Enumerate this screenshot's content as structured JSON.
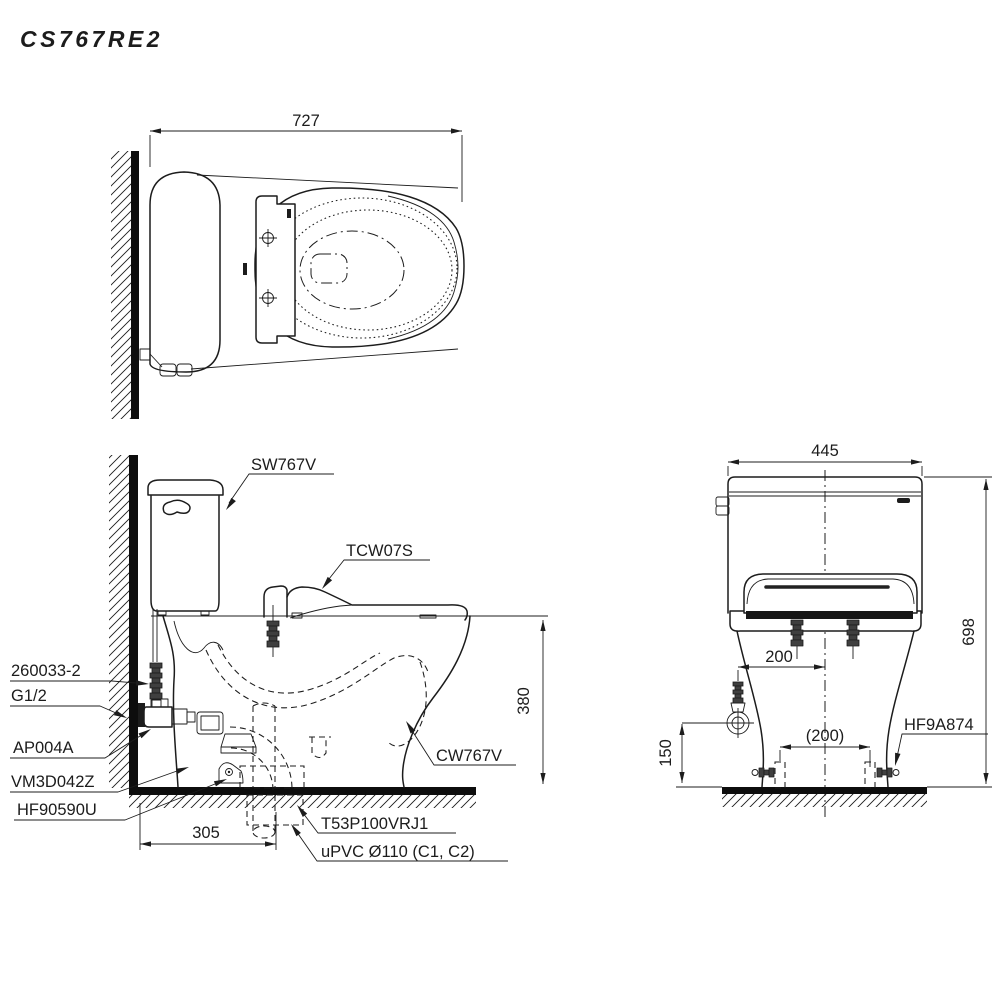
{
  "title": "CS767RE2",
  "top": {
    "dim_width": "727"
  },
  "side": {
    "dim_rim_height": "380",
    "dim_drain_offset": "305",
    "label_tank": "SW767V",
    "label_seat_unit": "TCW07S",
    "label_supply_hose": "260033-2",
    "label_thread": "G1/2",
    "label_stop_valve": "AP004A",
    "label_connector": "VM3D042Z",
    "label_floor_fixing": "HF90590U",
    "label_bowl": "CW767V",
    "label_flange": "T53P100VRJ1",
    "label_drain_pipe": "uPVC Ø110 (C1, C2)"
  },
  "front": {
    "dim_width": "445",
    "dim_height": "698",
    "dim_supply_offset": "200",
    "dim_bolt_spacing": "(200)",
    "dim_supply_height": "150",
    "label_bolt_cap": "HF9A874"
  }
}
